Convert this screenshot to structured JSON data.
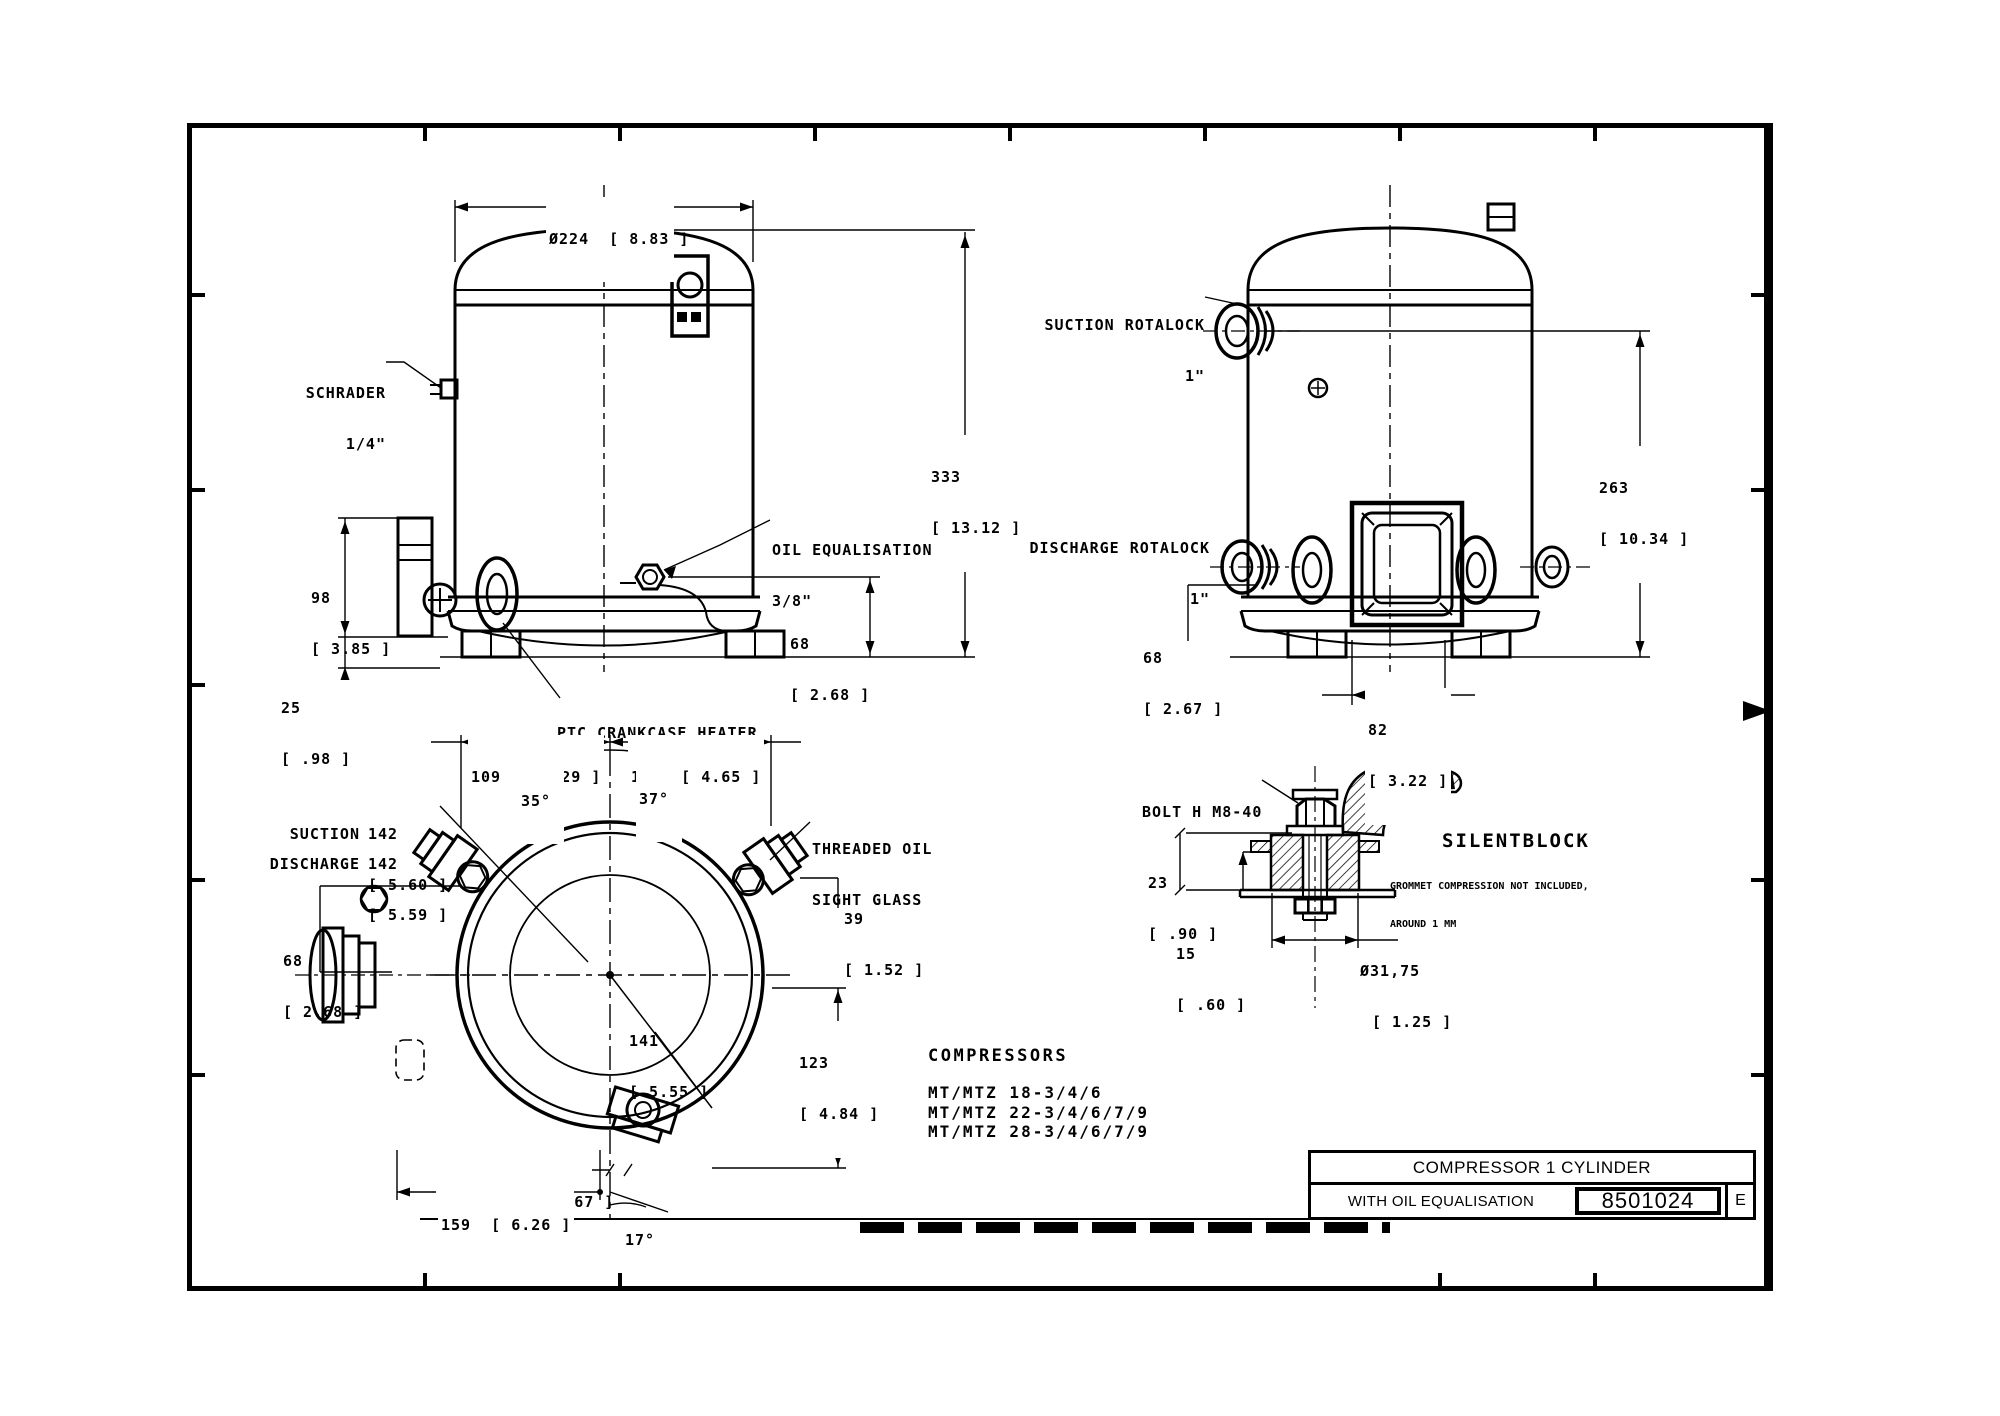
{
  "colors": {
    "ink": "#000000",
    "paper": "#ffffff"
  },
  "front_view": {
    "dia": "Ø224  [ 8.83 ]",
    "schrader_1": "SCHRADER",
    "schrader_2": "1/4\"",
    "oil_1": "OIL EQUALISATION",
    "oil_2": "3/8\"",
    "h_mm": "333",
    "h_in": "[ 13.12 ]",
    "d98_mm": "98",
    "d98_in": "[ 3.85 ]",
    "d25_mm": "25",
    "d25_in": "[ .98 ]",
    "d68_mm": "68",
    "d68_in": "[ 2.68 ]",
    "heater": "PTC CRANKCASE HEATER"
  },
  "side_view": {
    "suction_1": "SUCTION ROTALOCK",
    "suction_2": "1\"",
    "discharge_1": "DISCHARGE ROTALOCK",
    "discharge_2": "1\"",
    "d263_mm": "263",
    "d263_in": "[ 10.34 ]",
    "d68_mm": "68",
    "d68_in": "[ 2.67 ]",
    "d82_mm": "82",
    "d82_in": "[ 3.22 ]"
  },
  "top_view": {
    "d109": "109  [ 4.29 ]",
    "d118": "118  [ 4.65 ]",
    "a35": "35°",
    "a37": "37°",
    "a17": "17°",
    "suction_label": "SUCTION",
    "suction_mm": "142",
    "suction_in": "[ 5.60 ]",
    "discharge_label": "DISCHARGE",
    "discharge_mm": "142",
    "discharge_in": "[ 5.59 ]",
    "d68_mm": "68",
    "d68_in": "[ 2.68 ]",
    "sight_1": "THREADED OIL",
    "sight_2": "SIGHT GLASS",
    "d39_mm": "39",
    "d39_in": "[ 1.52 ]",
    "d141_mm": "141",
    "d141_in": "[ 5.55 ]",
    "d123_mm": "123",
    "d123_in": "[ 4.84 ]",
    "d17": "17  [ .67 ]",
    "d159": "159  [ 6.26 ]"
  },
  "silentblock": {
    "bolt": "BOLT H M8-40",
    "name": "SILENTBLOCK",
    "d23_mm": "23",
    "d23_in": "[ .90 ]",
    "d15_mm": "15",
    "d15_in": "[ .60 ]",
    "dia_mm": "Ø31,75",
    "dia_in": "[ 1.25 ]",
    "note_1": "GROMMET COMPRESSION NOT INCLUDED,",
    "note_2": "AROUND 1 MM"
  },
  "compressors": {
    "heading": "COMPRESSORS",
    "models": [
      "MT/MTZ 18-3/4/6",
      "MT/MTZ 22-3/4/6/7/9",
      "MT/MTZ 28-3/4/6/7/9"
    ]
  },
  "title_block": {
    "title": "COMPRESSOR 1 CYLINDER",
    "subtitle": "WITH OIL EQUALISATION",
    "drawing_number": "8501024",
    "revision": "E"
  }
}
